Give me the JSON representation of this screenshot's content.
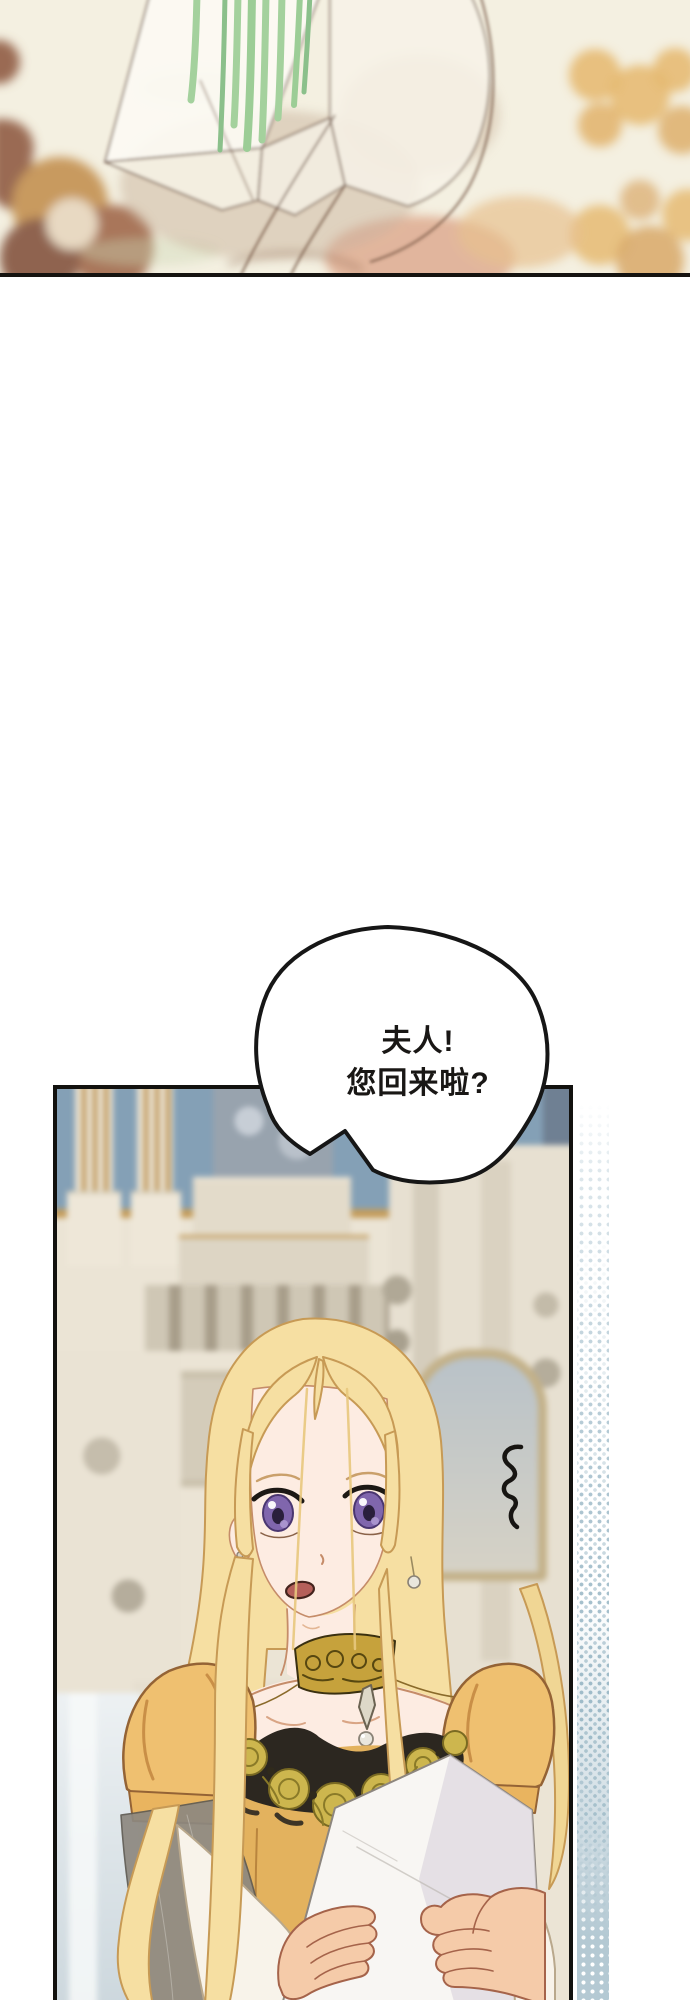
{
  "speech_bubble": {
    "line1": "夫人!",
    "line2": "您回来啦?"
  },
  "colors": {
    "page_background": "#ffffff",
    "panel_border": "#12110e",
    "top_panel_background": "#f4f0e1",
    "ornament_brown": "#9a6a52",
    "ornament_gold": "#e5b76c",
    "stem_green": "#a4d19d",
    "wall_blue": "#84a0b6",
    "gold_trim": "#c49d5c",
    "marble_beige": "#ddd5c4",
    "hair_blonde": "#f6dfa2",
    "skin": "#fdece2",
    "eye_purple": "#8066ad",
    "dress_yellow": "#efc070",
    "embroidery_gold": "#cdb64e",
    "lace_black": "#2c2720",
    "sheer_grey": "#8d8880",
    "paper_white": "#f8f6f3",
    "halftone_blue": "#9cb9c7"
  }
}
